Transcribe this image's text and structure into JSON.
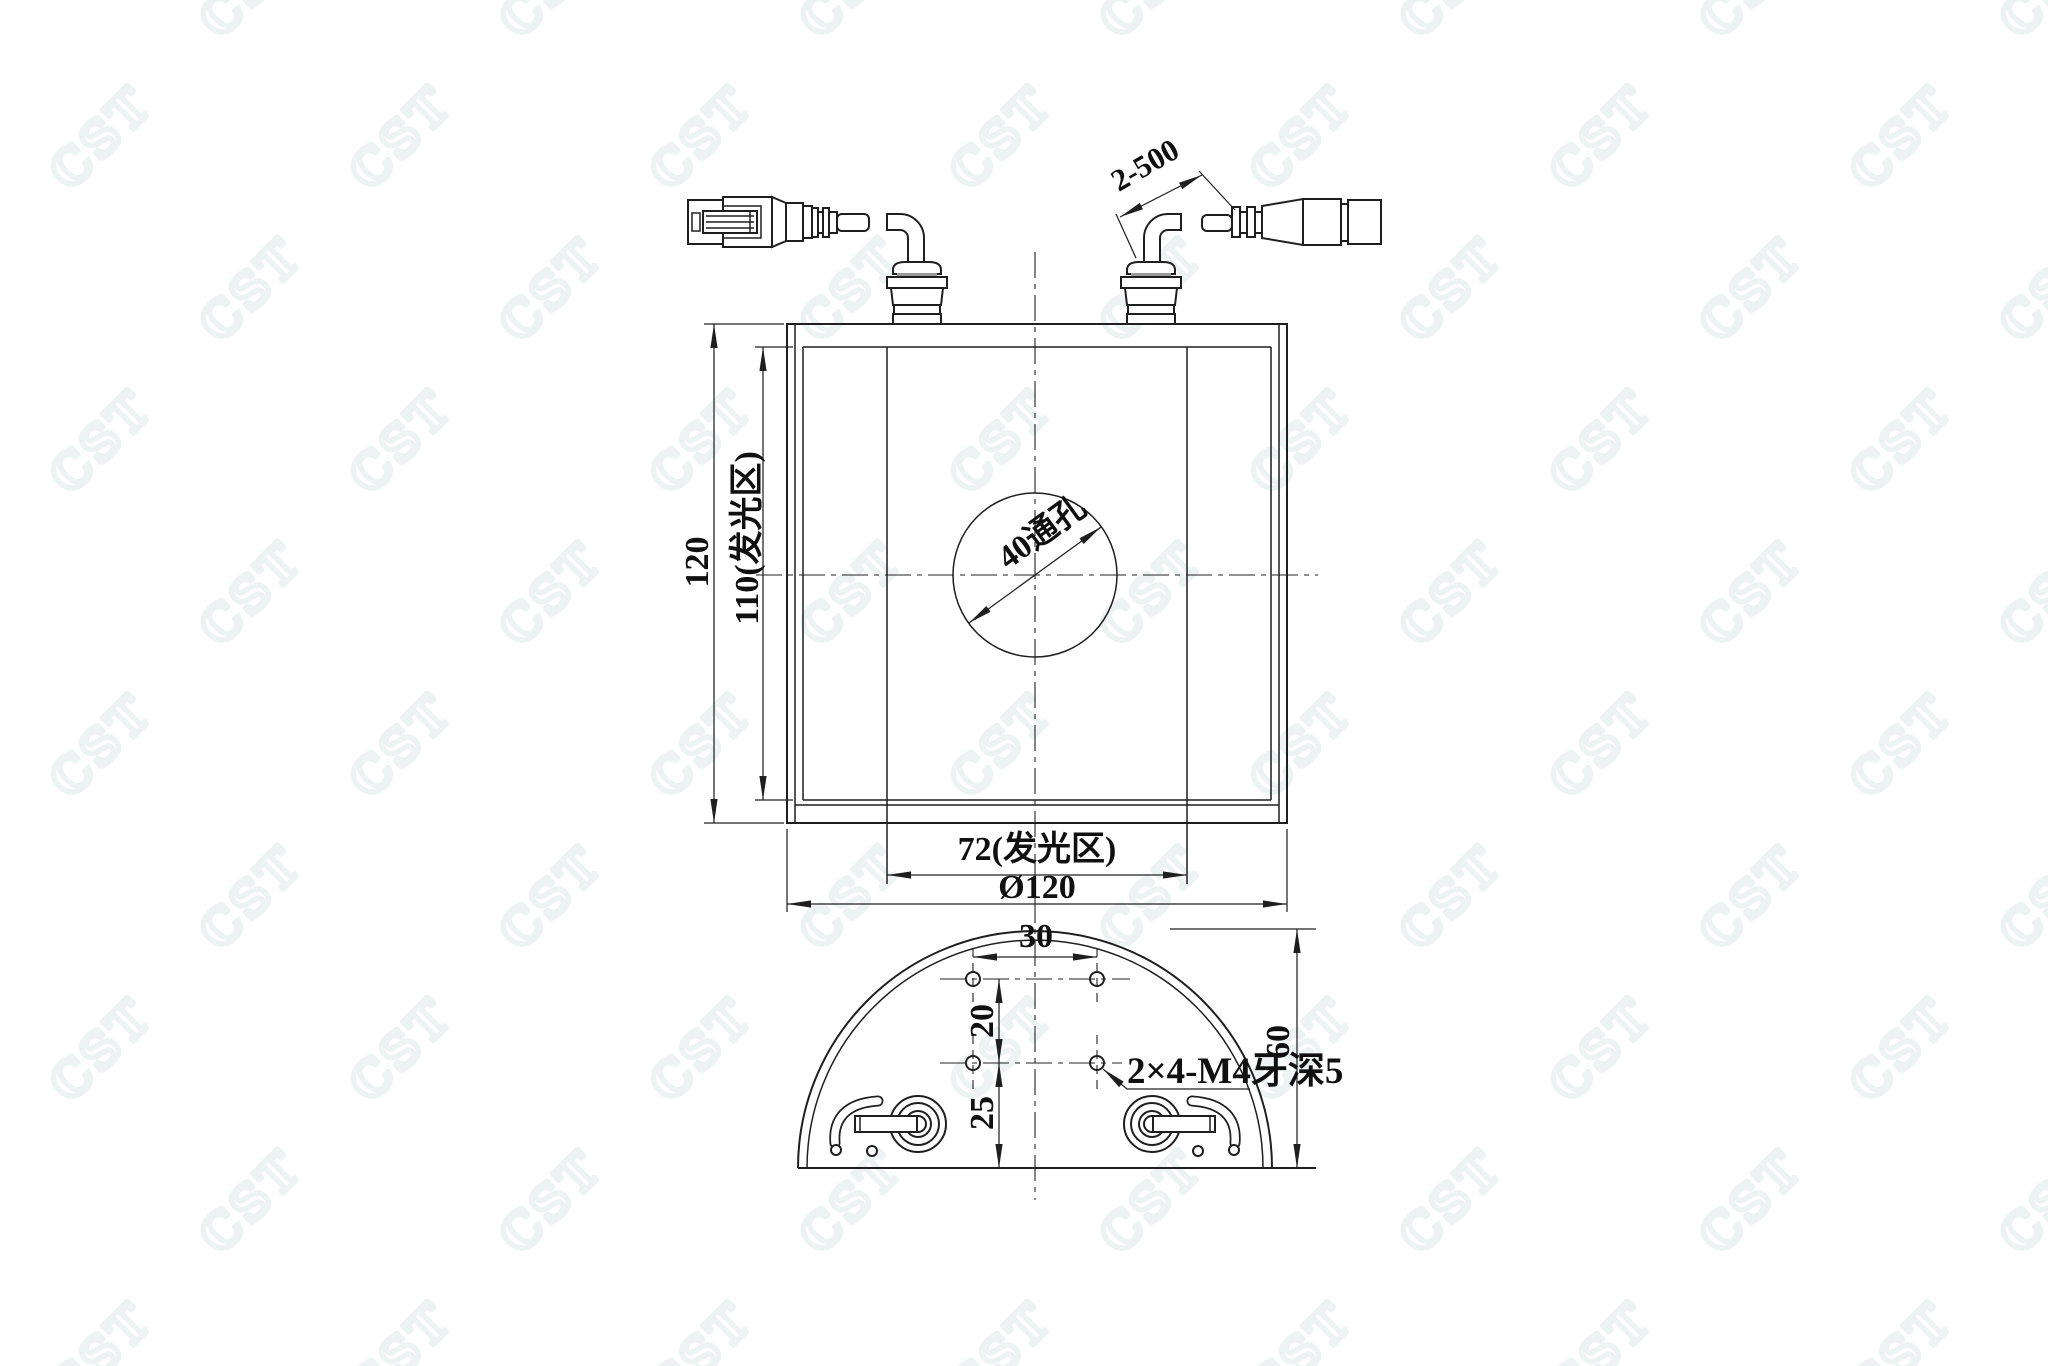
{
  "watermark": {
    "text": "CST",
    "color": "#edf2f2",
    "rotation_deg": -45
  },
  "line_color": "#1f1f1f",
  "front_view": {
    "height_total": "120",
    "height_glow": "110(发光区)",
    "width_glow": "72(发光区)",
    "width_total": "Ø120",
    "center_hole": "40通孔",
    "cable_spec": "2-500"
  },
  "bottom_view": {
    "hole_spacing_x": "30",
    "hole_spacing_y": "20",
    "hole_offset_bottom": "25",
    "dome_height": "60",
    "thread_note": "2×4-M4牙深5"
  }
}
